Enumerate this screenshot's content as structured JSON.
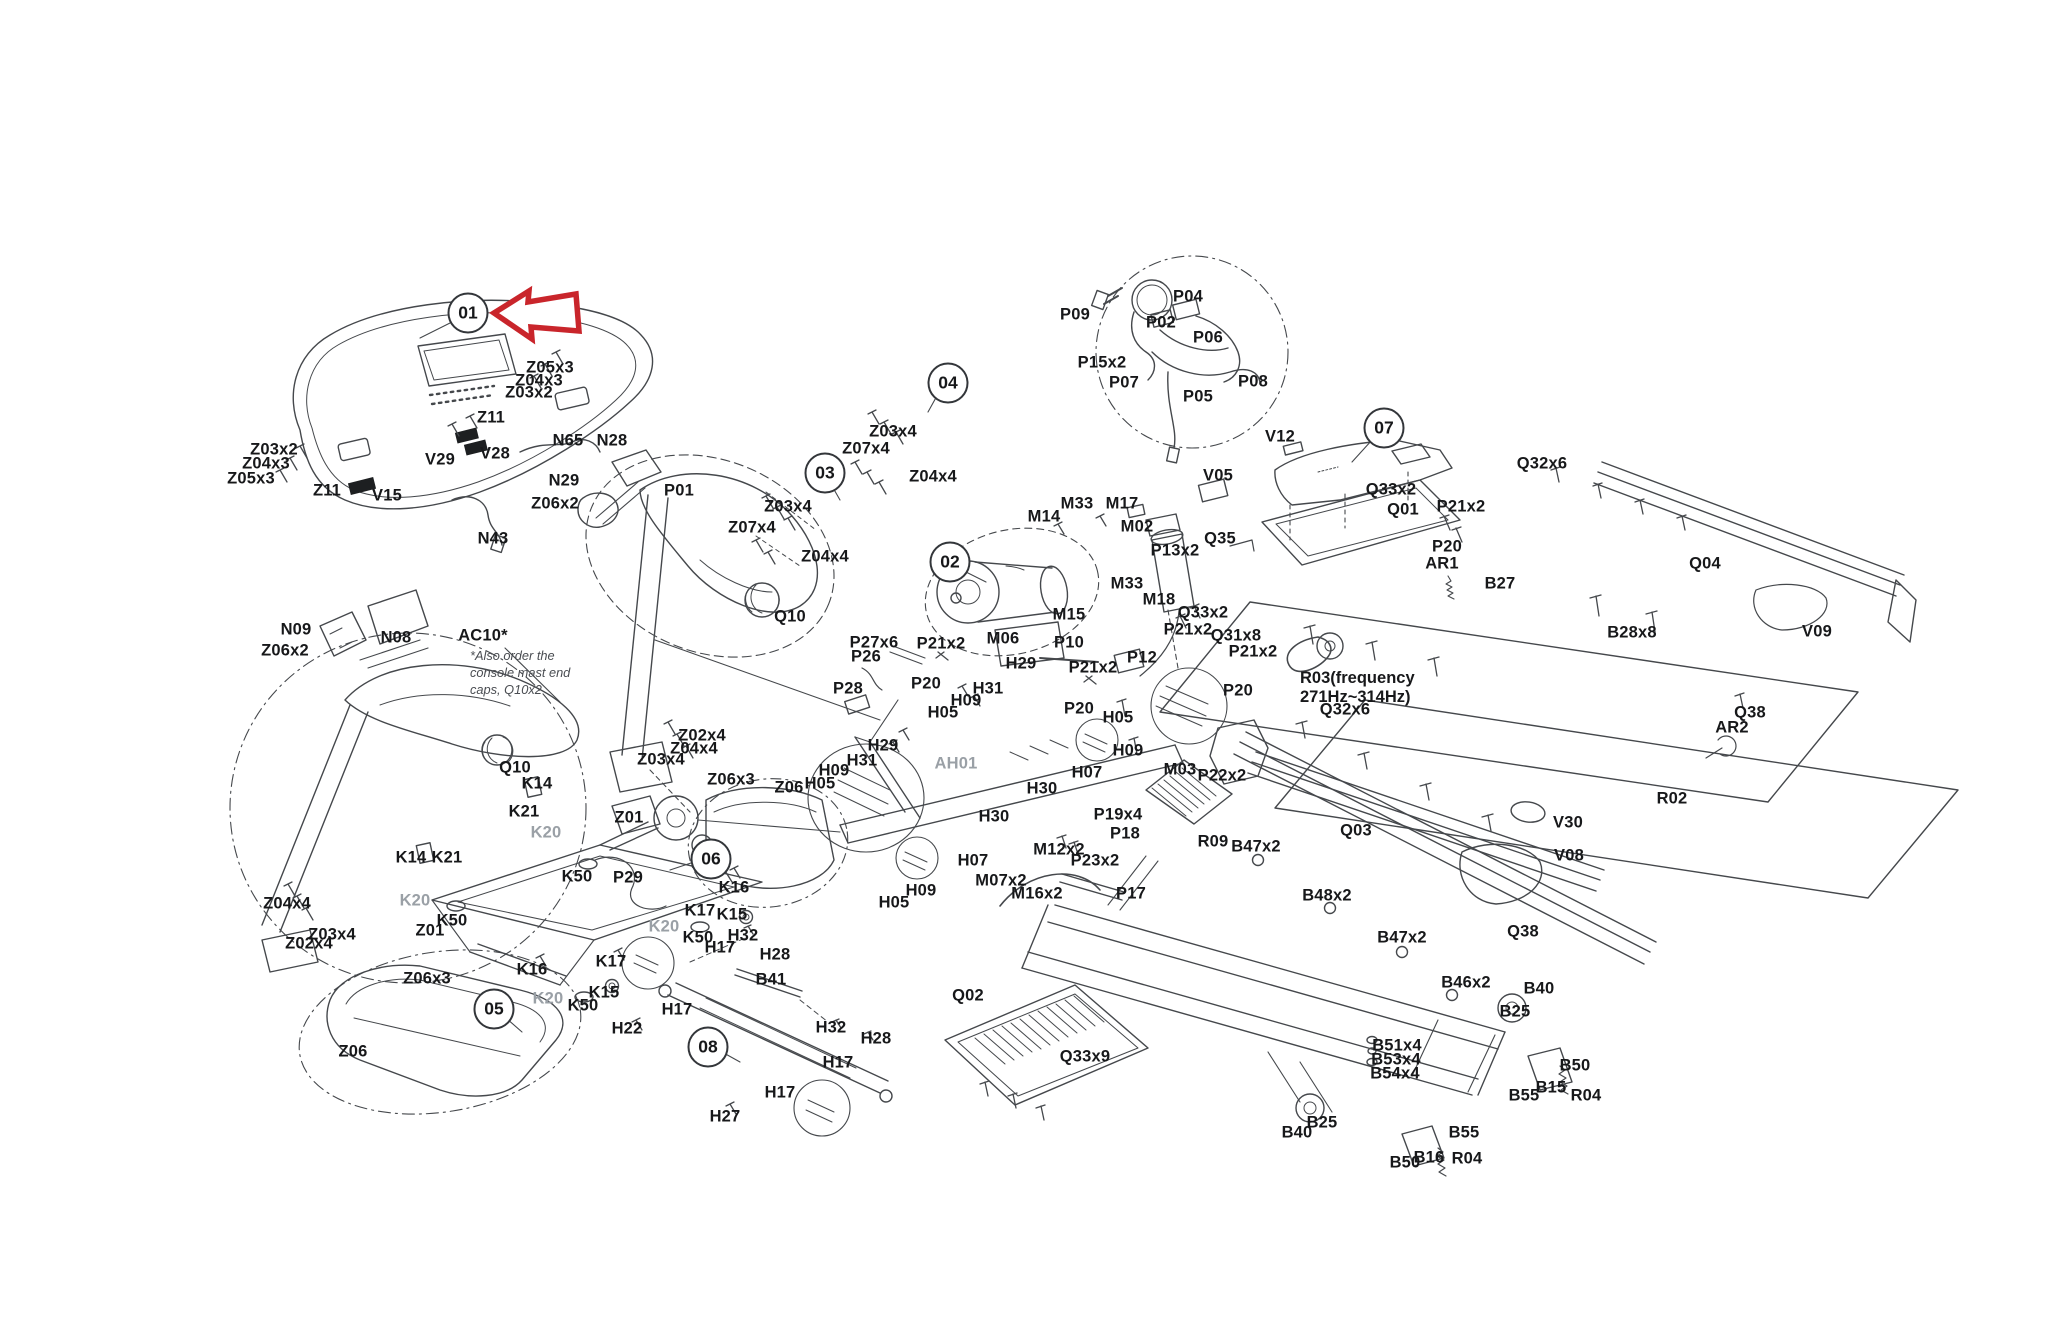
{
  "diagram": {
    "background": "#ffffff",
    "colors": {
      "line": "#45484c",
      "label": "#17181a",
      "muted": "#9aa0a6",
      "arrow_red": "#c9252b"
    },
    "arrow": {
      "points": "494,313 529,291 528,302 576,294 579,331 531,327 532,339",
      "target": "01"
    },
    "callouts": [
      {
        "id": "01",
        "x": 468,
        "y": 313
      },
      {
        "id": "02",
        "x": 950,
        "y": 562
      },
      {
        "id": "03",
        "x": 825,
        "y": 473
      },
      {
        "id": "04",
        "x": 948,
        "y": 383
      },
      {
        "id": "05",
        "x": 494,
        "y": 1009
      },
      {
        "id": "06",
        "x": 711,
        "y": 859
      },
      {
        "id": "07",
        "x": 1384,
        "y": 428
      },
      {
        "id": "08",
        "x": 708,
        "y": 1047
      }
    ],
    "notes": [
      {
        "id": "ac10-note",
        "style": "italic",
        "x": 470,
        "y": 648,
        "lines": [
          "*Also order the",
          "console mast end",
          "caps, Q10x2"
        ]
      },
      {
        "id": "r03-note",
        "style": "bold",
        "x": 1300,
        "y": 669,
        "lines": [
          "R03(frequency",
          "271Hz~314Hz)"
        ]
      }
    ],
    "labels": [
      {
        "t": "Z05x3",
        "x": 550,
        "y": 368
      },
      {
        "t": "Z04x3",
        "x": 539,
        "y": 381
      },
      {
        "t": "Z03x2",
        "x": 529,
        "y": 393
      },
      {
        "t": "Z11",
        "x": 491,
        "y": 418
      },
      {
        "t": "N65",
        "x": 568,
        "y": 441
      },
      {
        "t": "N28",
        "x": 612,
        "y": 441
      },
      {
        "t": "V28",
        "x": 495,
        "y": 454
      },
      {
        "t": "V29",
        "x": 440,
        "y": 460
      },
      {
        "t": "N29",
        "x": 564,
        "y": 481
      },
      {
        "t": "Z06x2",
        "x": 555,
        "y": 504
      },
      {
        "t": "P01",
        "x": 679,
        "y": 491
      },
      {
        "t": "V15",
        "x": 387,
        "y": 496
      },
      {
        "t": "N43",
        "x": 493,
        "y": 539
      },
      {
        "t": "Z03x2",
        "x": 274,
        "y": 450
      },
      {
        "t": "Z04x3",
        "x": 266,
        "y": 464
      },
      {
        "t": "Z05x3",
        "x": 251,
        "y": 479
      },
      {
        "t": "Z11",
        "x": 327,
        "y": 491
      },
      {
        "t": "Z03x4",
        "x": 893,
        "y": 432
      },
      {
        "t": "Z07x4",
        "x": 866,
        "y": 449
      },
      {
        "t": "Z04x4",
        "x": 933,
        "y": 477
      },
      {
        "t": "Z03x4",
        "x": 788,
        "y": 507
      },
      {
        "t": "Z07x4",
        "x": 752,
        "y": 528
      },
      {
        "t": "Z04x4",
        "x": 825,
        "y": 557
      },
      {
        "t": "Q10",
        "x": 790,
        "y": 617
      },
      {
        "t": "N09",
        "x": 296,
        "y": 630
      },
      {
        "t": "Z06x2",
        "x": 285,
        "y": 651
      },
      {
        "t": "N08",
        "x": 396,
        "y": 638
      },
      {
        "t": "AC10*",
        "x": 483,
        "y": 636
      },
      {
        "t": "Q10",
        "x": 515,
        "y": 768
      },
      {
        "t": "Z02x4",
        "x": 702,
        "y": 736
      },
      {
        "t": "Z04x4",
        "x": 694,
        "y": 749
      },
      {
        "t": "Z03x4",
        "x": 661,
        "y": 760
      },
      {
        "t": "K14",
        "x": 537,
        "y": 784
      },
      {
        "t": "K21",
        "x": 524,
        "y": 812
      },
      {
        "t": "K20",
        "x": 546,
        "y": 833,
        "m": 1
      },
      {
        "t": "Z01",
        "x": 629,
        "y": 818
      },
      {
        "t": "Z06x3",
        "x": 731,
        "y": 780
      },
      {
        "t": "Z06",
        "x": 789,
        "y": 788
      },
      {
        "t": "K14",
        "x": 411,
        "y": 858
      },
      {
        "t": "K21",
        "x": 447,
        "y": 858
      },
      {
        "t": "K20",
        "x": 415,
        "y": 901,
        "m": 1
      },
      {
        "t": "K50",
        "x": 452,
        "y": 921
      },
      {
        "t": "Z01",
        "x": 430,
        "y": 931
      },
      {
        "t": "Z04x4",
        "x": 287,
        "y": 904
      },
      {
        "t": "Z03x4",
        "x": 332,
        "y": 935
      },
      {
        "t": "Z02x4",
        "x": 309,
        "y": 944
      },
      {
        "t": "K50",
        "x": 577,
        "y": 877
      },
      {
        "t": "P29",
        "x": 628,
        "y": 878
      },
      {
        "t": "K16",
        "x": 734,
        "y": 888
      },
      {
        "t": "K17",
        "x": 700,
        "y": 911
      },
      {
        "t": "K15",
        "x": 732,
        "y": 915
      },
      {
        "t": "K20",
        "x": 664,
        "y": 927,
        "m": 1
      },
      {
        "t": "K50",
        "x": 698,
        "y": 938
      },
      {
        "t": "K17",
        "x": 611,
        "y": 962
      },
      {
        "t": "K16",
        "x": 532,
        "y": 970
      },
      {
        "t": "K20",
        "x": 548,
        "y": 999,
        "m": 1
      },
      {
        "t": "K15",
        "x": 604,
        "y": 993
      },
      {
        "t": "K50",
        "x": 583,
        "y": 1006
      },
      {
        "t": "Z06x3",
        "x": 427,
        "y": 979
      },
      {
        "t": "Z06",
        "x": 353,
        "y": 1052
      },
      {
        "t": "H32",
        "x": 743,
        "y": 936
      },
      {
        "t": "H17",
        "x": 720,
        "y": 948
      },
      {
        "t": "H28",
        "x": 775,
        "y": 955
      },
      {
        "t": "B41",
        "x": 771,
        "y": 980
      },
      {
        "t": "H17",
        "x": 677,
        "y": 1010
      },
      {
        "t": "H22",
        "x": 627,
        "y": 1029
      },
      {
        "t": "H32",
        "x": 831,
        "y": 1028
      },
      {
        "t": "H28",
        "x": 876,
        "y": 1039
      },
      {
        "t": "H17",
        "x": 838,
        "y": 1063
      },
      {
        "t": "H17",
        "x": 780,
        "y": 1093
      },
      {
        "t": "H27",
        "x": 725,
        "y": 1117
      },
      {
        "t": "H29",
        "x": 883,
        "y": 746
      },
      {
        "t": "H31",
        "x": 862,
        "y": 761
      },
      {
        "t": "H09",
        "x": 834,
        "y": 771
      },
      {
        "t": "H05",
        "x": 820,
        "y": 784
      },
      {
        "t": "AH01",
        "x": 956,
        "y": 764,
        "m": 1
      },
      {
        "t": "H30",
        "x": 1042,
        "y": 789
      },
      {
        "t": "H30",
        "x": 994,
        "y": 817
      },
      {
        "t": "H07",
        "x": 973,
        "y": 861
      },
      {
        "t": "H09",
        "x": 921,
        "y": 891
      },
      {
        "t": "H05",
        "x": 894,
        "y": 903
      },
      {
        "t": "H29",
        "x": 1021,
        "y": 664
      },
      {
        "t": "H31",
        "x": 988,
        "y": 689
      },
      {
        "t": "H09",
        "x": 966,
        "y": 701
      },
      {
        "t": "H05",
        "x": 943,
        "y": 713
      },
      {
        "t": "P20",
        "x": 1079,
        "y": 709
      },
      {
        "t": "H05",
        "x": 1118,
        "y": 718
      },
      {
        "t": "H09",
        "x": 1128,
        "y": 751
      },
      {
        "t": "H07",
        "x": 1087,
        "y": 773
      },
      {
        "t": "P21x2",
        "x": 1093,
        "y": 668
      },
      {
        "t": "P27x6",
        "x": 874,
        "y": 643
      },
      {
        "t": "P26",
        "x": 866,
        "y": 657
      },
      {
        "t": "P28",
        "x": 848,
        "y": 689
      },
      {
        "t": "P21x2",
        "x": 941,
        "y": 644
      },
      {
        "t": "P20",
        "x": 926,
        "y": 684
      },
      {
        "t": "M06",
        "x": 1003,
        "y": 639
      },
      {
        "t": "P10",
        "x": 1069,
        "y": 643
      },
      {
        "t": "P12",
        "x": 1142,
        "y": 658
      },
      {
        "t": "P13x2",
        "x": 1175,
        "y": 551
      },
      {
        "t": "M14",
        "x": 1044,
        "y": 517
      },
      {
        "t": "M33",
        "x": 1077,
        "y": 504
      },
      {
        "t": "M17",
        "x": 1122,
        "y": 504
      },
      {
        "t": "M02",
        "x": 1137,
        "y": 527
      },
      {
        "t": "M33",
        "x": 1127,
        "y": 584
      },
      {
        "t": "M18",
        "x": 1159,
        "y": 600
      },
      {
        "t": "M15",
        "x": 1069,
        "y": 615
      },
      {
        "t": "M03",
        "x": 1180,
        "y": 770
      },
      {
        "t": "P22x2",
        "x": 1222,
        "y": 776
      },
      {
        "t": "P19x4",
        "x": 1118,
        "y": 815
      },
      {
        "t": "P18",
        "x": 1125,
        "y": 834
      },
      {
        "t": "R09",
        "x": 1213,
        "y": 842
      },
      {
        "t": "B47x2",
        "x": 1256,
        "y": 847
      },
      {
        "t": "M12x2",
        "x": 1059,
        "y": 850
      },
      {
        "t": "P23x2",
        "x": 1095,
        "y": 861
      },
      {
        "t": "M07x2",
        "x": 1001,
        "y": 881
      },
      {
        "t": "M16x2",
        "x": 1037,
        "y": 894
      },
      {
        "t": "P17",
        "x": 1131,
        "y": 894
      },
      {
        "t": "Q02",
        "x": 968,
        "y": 996
      },
      {
        "t": "Q33x9",
        "x": 1085,
        "y": 1057
      },
      {
        "t": "Q33x2",
        "x": 1203,
        "y": 613
      },
      {
        "t": "Q31x8",
        "x": 1236,
        "y": 636
      },
      {
        "t": "P21x2",
        "x": 1188,
        "y": 630
      },
      {
        "t": "P21x2",
        "x": 1253,
        "y": 652
      },
      {
        "t": "P20",
        "x": 1238,
        "y": 691
      },
      {
        "t": "Q32x6",
        "x": 1345,
        "y": 710
      },
      {
        "t": "Q03",
        "x": 1356,
        "y": 831
      },
      {
        "t": "AR1",
        "x": 1442,
        "y": 564
      },
      {
        "t": "B27",
        "x": 1500,
        "y": 584
      },
      {
        "t": "B28x8",
        "x": 1632,
        "y": 633
      },
      {
        "t": "P20",
        "x": 1447,
        "y": 547
      },
      {
        "t": "P21x2",
        "x": 1461,
        "y": 507
      },
      {
        "t": "Q01",
        "x": 1403,
        "y": 510
      },
      {
        "t": "Q33x2",
        "x": 1391,
        "y": 490
      },
      {
        "t": "V12",
        "x": 1280,
        "y": 437
      },
      {
        "t": "V05",
        "x": 1218,
        "y": 476
      },
      {
        "t": "Q35",
        "x": 1220,
        "y": 539
      },
      {
        "t": "Q32x6",
        "x": 1542,
        "y": 464
      },
      {
        "t": "Q04",
        "x": 1705,
        "y": 564
      },
      {
        "t": "V09",
        "x": 1817,
        "y": 632
      },
      {
        "t": "Q38",
        "x": 1750,
        "y": 713
      },
      {
        "t": "AR2",
        "x": 1732,
        "y": 728
      },
      {
        "t": "R02",
        "x": 1672,
        "y": 799
      },
      {
        "t": "V30",
        "x": 1568,
        "y": 823
      },
      {
        "t": "V08",
        "x": 1569,
        "y": 856
      },
      {
        "t": "B48x2",
        "x": 1327,
        "y": 896
      },
      {
        "t": "B47x2",
        "x": 1402,
        "y": 938
      },
      {
        "t": "Q38",
        "x": 1523,
        "y": 932
      },
      {
        "t": "B46x2",
        "x": 1466,
        "y": 983
      },
      {
        "t": "B40",
        "x": 1539,
        "y": 989
      },
      {
        "t": "B25",
        "x": 1515,
        "y": 1012
      },
      {
        "t": "B51x4",
        "x": 1397,
        "y": 1046
      },
      {
        "t": "B53x4",
        "x": 1396,
        "y": 1060
      },
      {
        "t": "B54x4",
        "x": 1395,
        "y": 1074
      },
      {
        "t": "B50",
        "x": 1575,
        "y": 1066
      },
      {
        "t": "B15",
        "x": 1551,
        "y": 1088
      },
      {
        "t": "B55",
        "x": 1524,
        "y": 1096
      },
      {
        "t": "R04",
        "x": 1586,
        "y": 1096
      },
      {
        "t": "B25",
        "x": 1322,
        "y": 1123
      },
      {
        "t": "B40",
        "x": 1297,
        "y": 1133
      },
      {
        "t": "B55",
        "x": 1464,
        "y": 1133
      },
      {
        "t": "B16",
        "x": 1429,
        "y": 1158
      },
      {
        "t": "R04",
        "x": 1467,
        "y": 1159
      },
      {
        "t": "B50",
        "x": 1405,
        "y": 1163
      },
      {
        "t": "P09",
        "x": 1075,
        "y": 315
      },
      {
        "t": "P04",
        "x": 1188,
        "y": 297
      },
      {
        "t": "P02",
        "x": 1161,
        "y": 323
      },
      {
        "t": "P06",
        "x": 1208,
        "y": 338
      },
      {
        "t": "P15x2",
        "x": 1102,
        "y": 363
      },
      {
        "t": "P07",
        "x": 1124,
        "y": 383
      },
      {
        "t": "P05",
        "x": 1198,
        "y": 397
      },
      {
        "t": "P08",
        "x": 1253,
        "y": 382
      }
    ]
  }
}
